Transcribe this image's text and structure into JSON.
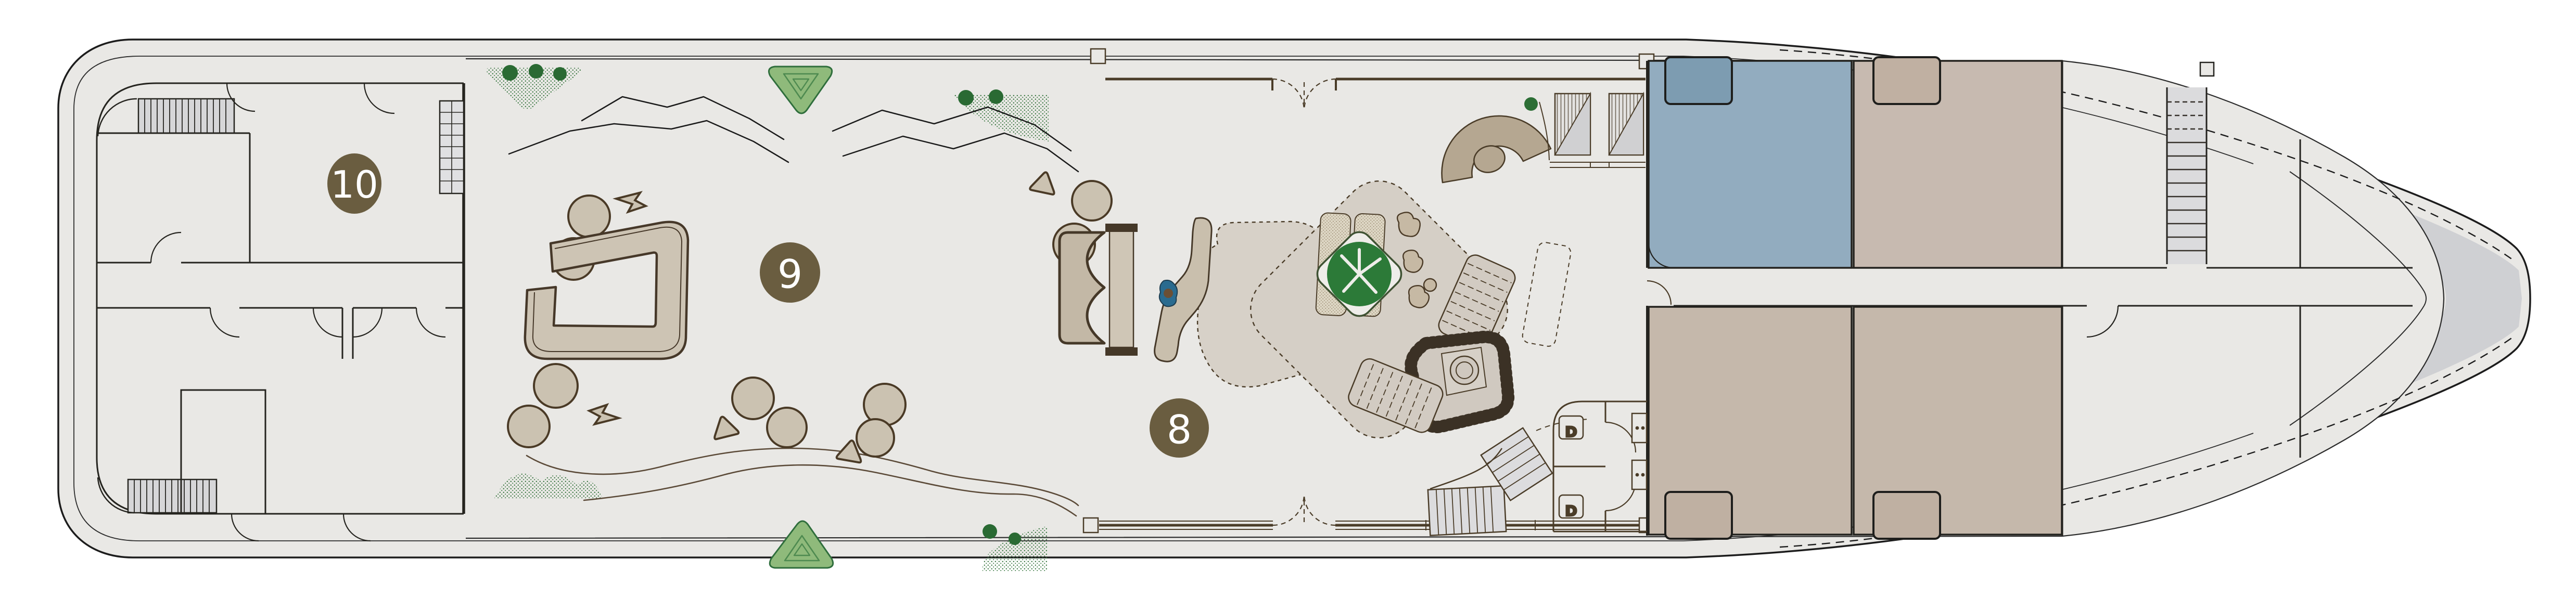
{
  "plan": {
    "badges": [
      {
        "id": "area-10",
        "label": "10"
      },
      {
        "id": "area-9",
        "label": "9"
      },
      {
        "id": "area-8",
        "label": "8"
      }
    ],
    "restroom": {
      "stall_labels": [
        "D",
        "D"
      ]
    },
    "colors": {
      "floor": "#e9e8e5",
      "hull": "#d2d3d5",
      "bow_shadow": "#cfd0d3",
      "wall_dark": "#222220",
      "lounge_wall": "#4a3c28",
      "furniture_fill": "#cbc2b1",
      "furniture_outline": "#4a3a26",
      "rug": "#d5cfc6",
      "cabin_blue": "#92acbf",
      "bed_blue": "#7d9cb1",
      "cabin_tan": "#c7bab0",
      "bed_tan": "#c0b0a2",
      "badge": "#6a5d40",
      "plant_dark": "#2d6f35",
      "plant_light": "#8fba7b",
      "stair_tread": "#d9d9db"
    }
  }
}
